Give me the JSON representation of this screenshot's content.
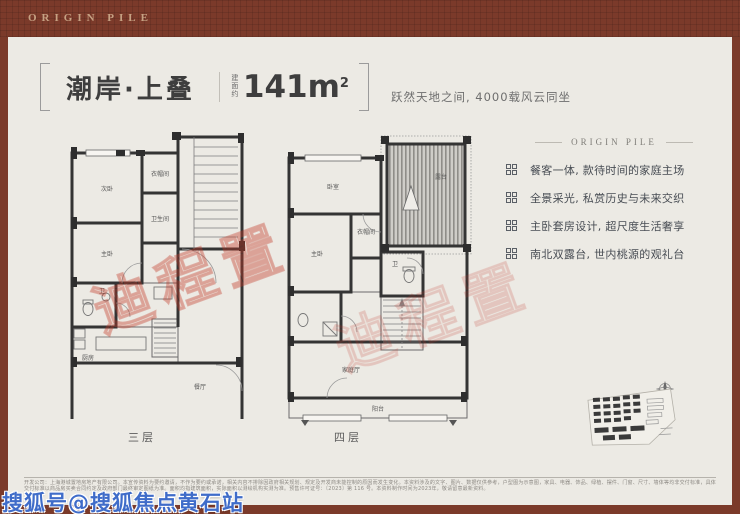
{
  "brand": {
    "logo_text": "ORIGIN PILE"
  },
  "title": {
    "name": "潮岸·上叠",
    "area_prefix": "建面约",
    "area_value": "141m",
    "area_sup": "2",
    "subtitle": "跃然天地之间, 4000载风云同坐"
  },
  "features": {
    "header": "ORIGIN PILE",
    "items": [
      {
        "text": "餐客一体, 款待时间的家庭主场"
      },
      {
        "text": "全景采光, 私赏历史与未来交织"
      },
      {
        "text": "主卧套房设计, 超尺度生活奢享"
      },
      {
        "text": "南北双露台, 世内桃源的观礼台"
      }
    ]
  },
  "plans": [
    {
      "label": "三层",
      "rooms": [
        "次卧",
        "衣帽间",
        "卫生间",
        "主卧",
        "卫",
        "厨房",
        "餐厅",
        "客厅",
        "阳台"
      ]
    },
    {
      "label": "四层",
      "rooms": [
        "卧室",
        "露台",
        "衣帽间",
        "主卧",
        "卫",
        "家庭厅",
        "阳台"
      ]
    }
  ],
  "watermarks": {
    "red_stamp": "迪程置",
    "blue_byline": "搜狐号@搜狐焦点黄石站"
  },
  "footer": {
    "disclaimer": "开发公司：上海港城置地房地产有限公司。本宣传资料为要约邀请，不作为要约或承诺，相关内容不排除因政府相关规划、规定及开发商未能控制的原因而发生变化。本资料涉及的文字、图片、数据仅供参考，户型图为示意图，家具、电器、饰品、绿植、摆件、门窗、尺寸、墙体等均非交付标准，具体交付标准以商品房买卖合同约定及政府部门最终审定图纸为准。面积均指建筑面积，实际面积以测绘机构实测为准。预售许可证号：〔2023〕第 116 号。本资料制作时间为2023年，敬请留意最新资料。"
  },
  "colors": {
    "frame_red": "#7b3a2a",
    "logo_gold": "#c6a183",
    "paper": "#eceae4",
    "text_dark": "#3e3e3e",
    "feature_text": "#484d54",
    "plan_line": "#343434",
    "stamp_red": "#c03a2a",
    "byline_blue": "#3f6cc9"
  }
}
